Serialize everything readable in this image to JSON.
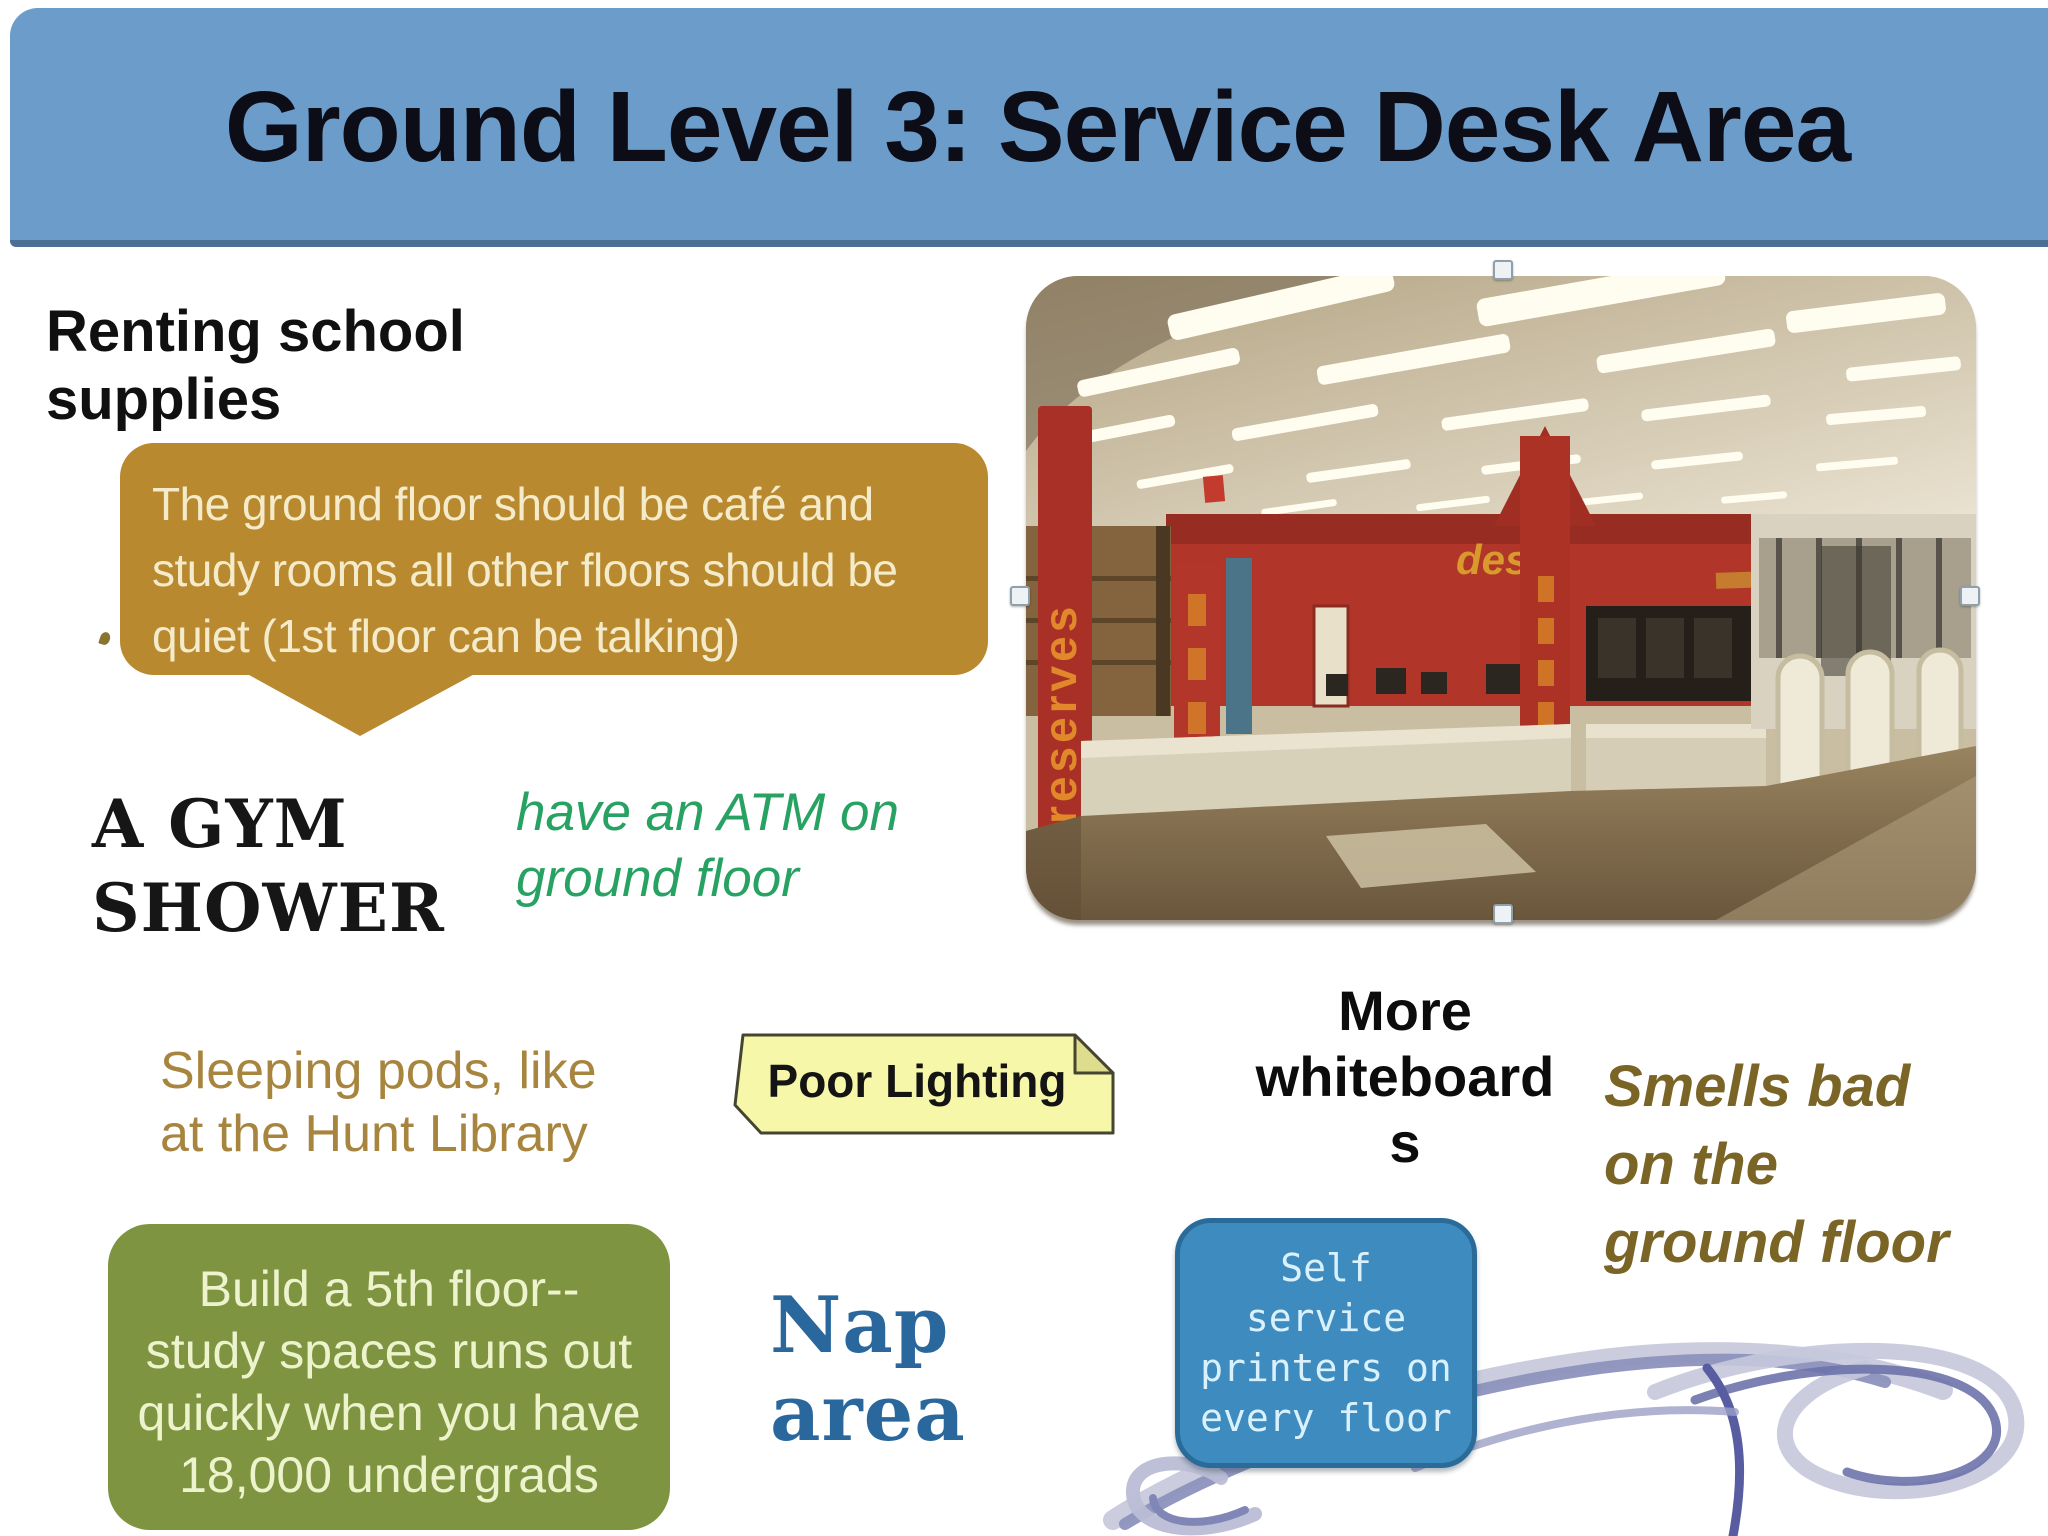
{
  "slide": {
    "title": "Ground Level 3: Service Desk Area"
  },
  "notes": {
    "renting": {
      "lines": [
        "Renting school",
        "supplies"
      ]
    },
    "bubble": {
      "lines": [
        "The ground floor should be café and",
        "study rooms all other floors should be",
        "quiet (1st floor can be talking)"
      ]
    },
    "gym": {
      "lines": [
        "A GYM",
        "SHOWER"
      ]
    },
    "atm": {
      "lines": [
        "have an ATM on",
        "ground floor"
      ]
    },
    "sleeping": {
      "lines": [
        "Sleeping pods, like",
        "at the Hunt Library"
      ]
    },
    "poor_lighting": {
      "label": "Poor Lighting"
    },
    "whiteboards": {
      "lines": [
        "More",
        "whiteboard",
        "s"
      ]
    },
    "smells": {
      "lines": [
        "Smells bad",
        "on the",
        "ground floor"
      ]
    },
    "build": {
      "lines": [
        "Build a 5th floor--",
        "study spaces runs out",
        "quickly when you have",
        "18,000 undergrads"
      ]
    },
    "nap": {
      "lines": [
        "Nap",
        "area"
      ]
    },
    "printers": {
      "lines": [
        "Self",
        "service",
        "printers on",
        "every floor"
      ]
    }
  },
  "photo": {
    "description": "Library lobby service desk area: red walls and banners, beige counters, security gates, fluorescent ceiling lights",
    "signs": {
      "reserves": "reserves",
      "desk": "desk"
    }
  },
  "colors": {
    "banner": "#6c9cca",
    "banner_border": "#4c7095",
    "title_text": "#0d0d17",
    "bubble": "#b8892f",
    "bubble_text": "#f4ebcb",
    "atm_green": "#28a263",
    "sleeping_gold": "#a8853e",
    "plaque_yellow": "#f7f7a9",
    "olive_box": "#7e9440",
    "olive_text": "#edf3cd",
    "nap_blue": "#2a679c",
    "printer_box": "#3e8bc0",
    "printer_border": "#2b6b99",
    "smells_brown": "#7a6426",
    "scribble": "#8d92bd"
  }
}
